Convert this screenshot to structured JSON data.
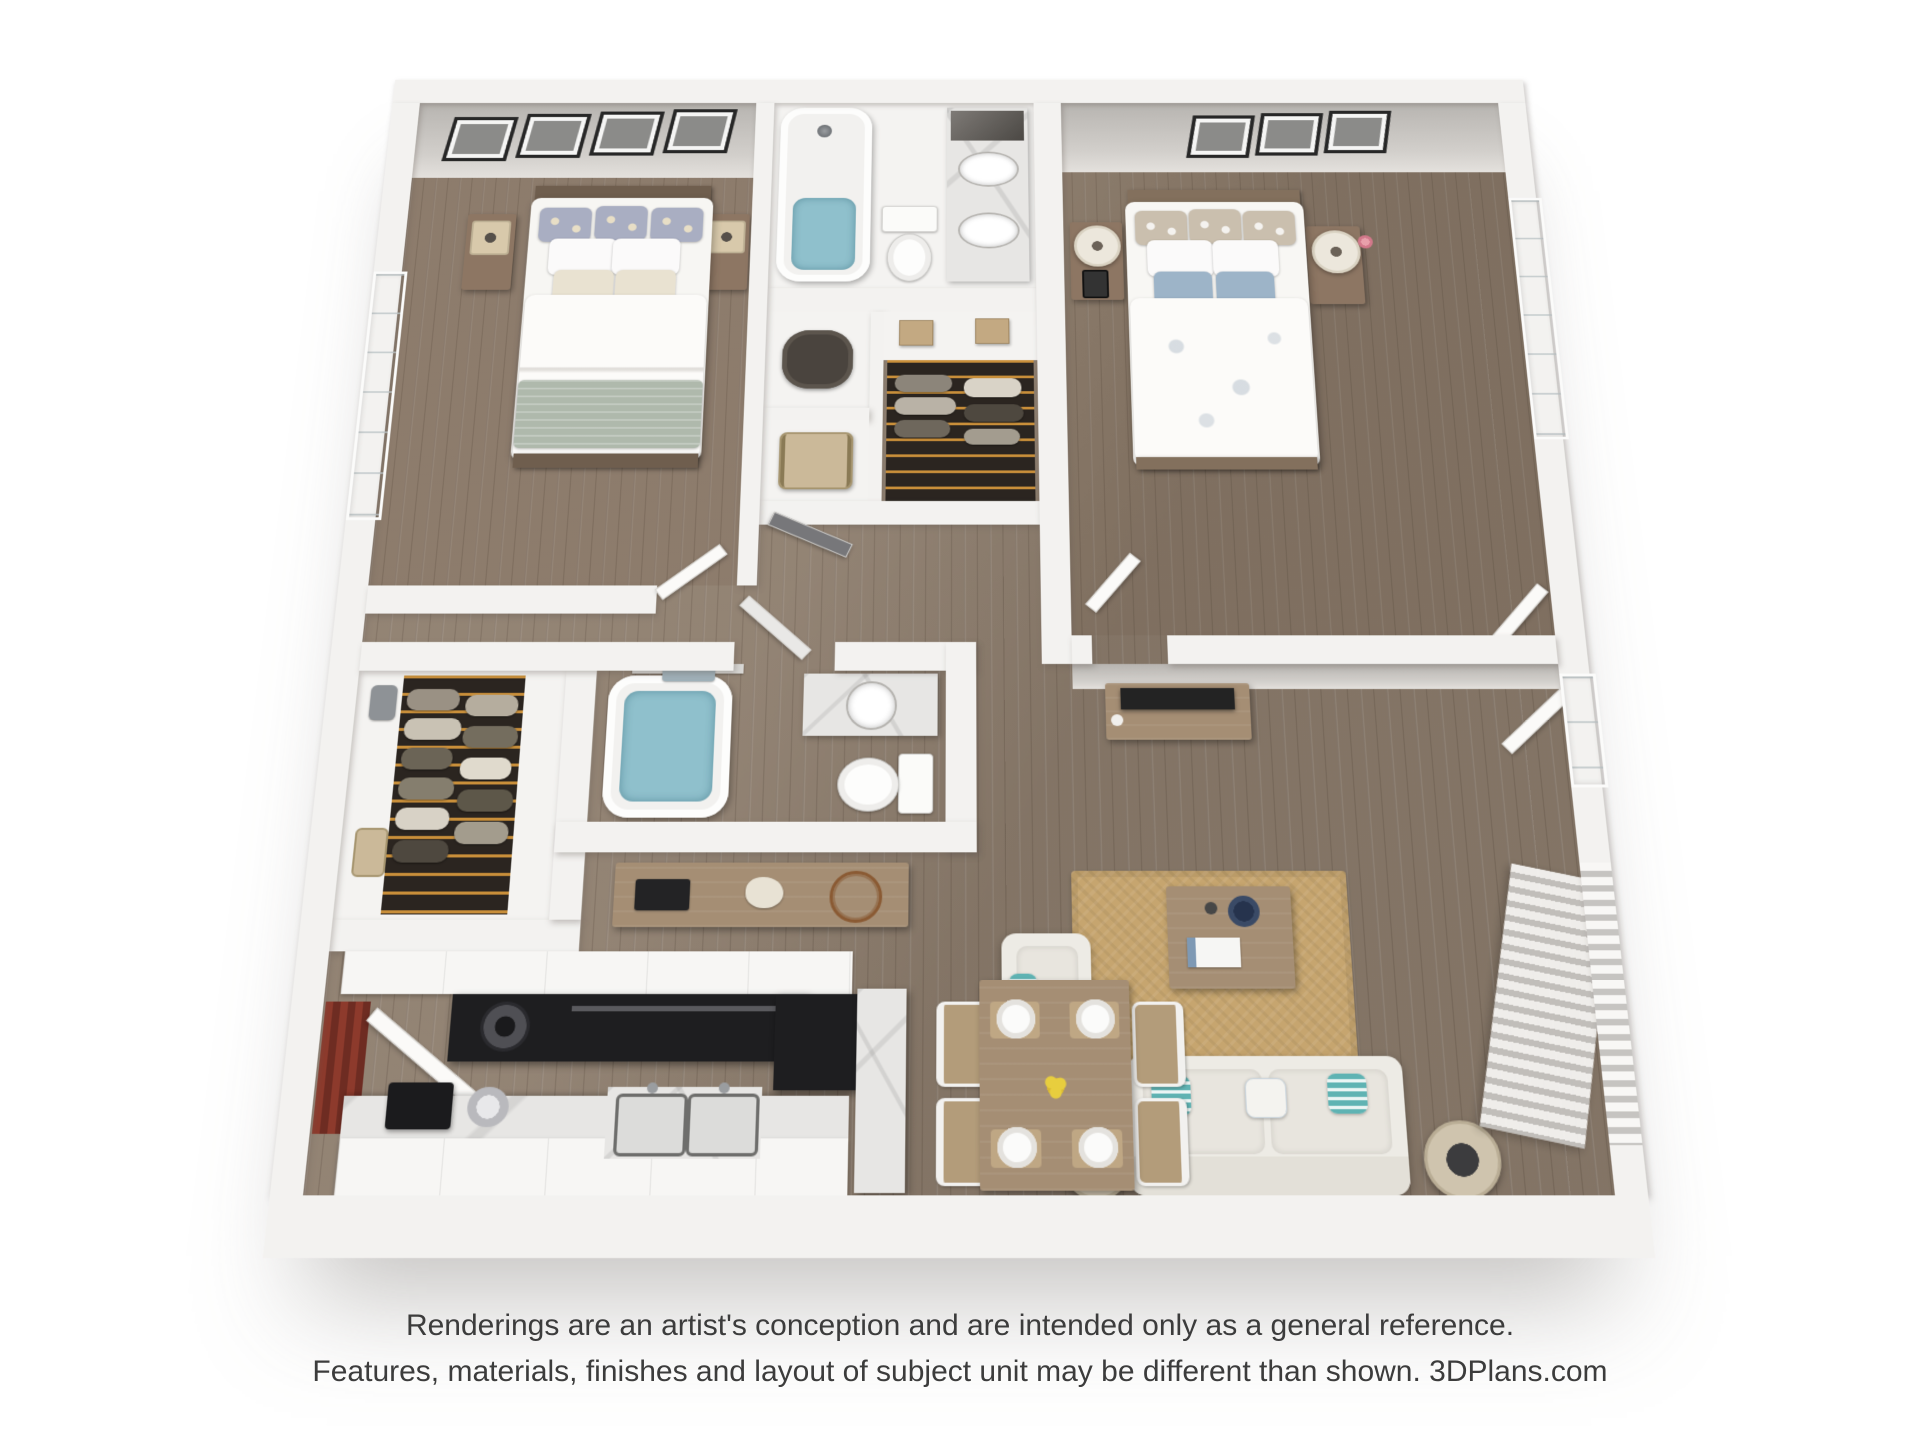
{
  "disclaimer": {
    "line1": "Renderings are an artist's conception and are intended only as a general reference.",
    "line2": "Features, materials, finishes and layout of subject unit may be different than shown. 3DPlans.com"
  },
  "palette": {
    "wall": "#f3f2f0",
    "wallFace": "#c5c2be",
    "floorWood": "#8d7d6d",
    "floorBath": "#f4f3f1",
    "rug": "#c6a56f",
    "sofa": "#edebe5",
    "accentTeal": "#5fb3b3",
    "accentBlue": "#9db4c8",
    "sageBlanket": "#afb9ac",
    "woodFurniture": "#8d7663",
    "woodTable": "#a58e74",
    "tv": "#232323",
    "appliance": "#1e1e20",
    "marble": "#e7e6e4",
    "water": "#8fc0cc",
    "closet": "#2b2520",
    "hanger": "#c98f3a",
    "pantryAccent": "#8d3a2c",
    "text": "#3c3c3c"
  }
}
